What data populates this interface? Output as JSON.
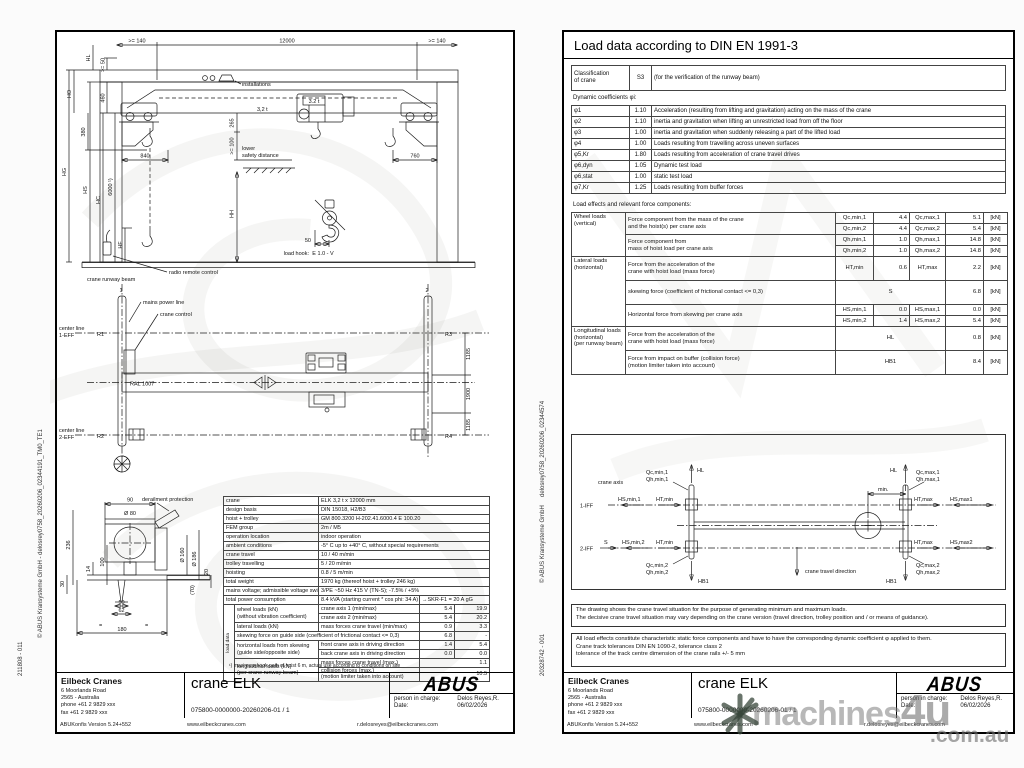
{
  "lp": {
    "side_copyright": "© ABUS Kransysteme GmbH - delosrey0758_20260206_02344191_TM0_TE1",
    "side_number": "211808 - 011",
    "draw": {
      "dim_140a": ">= 140",
      "dim_12000": "12000",
      "dim_140b": ">= 140",
      "hl": "HL",
      "dim_50": ">= 50",
      "ho": "HO",
      "dim_460": "460",
      "dim_380": "380",
      "hg": "HG",
      "hs": "HS",
      "hc": "HC",
      "dim_6000": "6000 ¹)",
      "hf": "HF",
      "hh": "HH",
      "installations": "installations",
      "beam_capacity": "3,2 t",
      "hoist_capacity": "3.2 t",
      "dim_265": "265",
      "dim_100": ">= 100",
      "lower": "lower",
      "safety_distance": "safety distance",
      "dim_840": "840",
      "dim_760": "760",
      "load_hook": "load hook:",
      "hook_type": "E 1.0 - V",
      "dim_hook_50": "50",
      "radio": "radio remote control",
      "runway_beam": "crane runway beam",
      "rail_1": "1",
      "rail_2": "2",
      "mains": "mains power line",
      "crane_control": "crane control",
      "center_line_1a": "center line",
      "center_line_1b": "1-EFF",
      "center_line_2a": "center line",
      "center_line_2b": "2-EFF",
      "r1": "R1",
      "r2": "R2",
      "r3": "R3",
      "r4": "R4",
      "ral": "RAL 1007",
      "dim_1185a": "1185",
      "dim_1900": "1900",
      "dim_1185b": "1185",
      "derailment": "derailment protection",
      "dim_90": "90",
      "dim_d80": "Ø 80",
      "dim_236": "236",
      "dim_100b": "100",
      "dim_14": "14",
      "dim_30": "30",
      "dim_d160": "Ø 160",
      "dim_d186": "Ø 186",
      "dim_20": "20",
      "dim_50b": "50",
      "dim_62": "62",
      "dim_180": "180",
      "dim_70": "(70)",
      "eq1": "=",
      "eq2": "="
    },
    "spec": {
      "rows": [
        {
          "l": "crane",
          "v": "ELK  3,2 t x 12000 mm"
        },
        {
          "l": "design basis",
          "v": "DIN 15018, H2/B3"
        },
        {
          "l": "hoist + trolley",
          "v": "GM 800.3200 H-202.41.6000.4 E 100.20"
        },
        {
          "l": "FEM group",
          "v": "2m / M5"
        },
        {
          "l": "operation location",
          "v": "indoor operation"
        },
        {
          "l": "ambient conditions",
          "v": "-5° C up to +40° C, without special requirements"
        },
        {
          "l": "crane travel",
          "v": "10 / 40 m/min"
        },
        {
          "l": "trolley travelling",
          "v": "5 / 20 m/min"
        },
        {
          "l": "hoisting",
          "v": "0.8 / 5 m/min"
        },
        {
          "l": "total weight",
          "v": "1970 kg (thereof hoist + trolley 246 kg)"
        },
        {
          "l": "mains voltage; admissible voltage swing",
          "v": "3/PE ~50 Hz 415 V (TN-S); -7.5% / +5%"
        }
      ],
      "power": {
        "l": "total power consumption",
        "v": "8.4 kVA (starting current * cos phi: 34 A)",
        "extra": "→SKR-F1 = 20 A gG"
      }
    },
    "ld": {
      "side": "load data",
      "wheel_l1": "wheel loads (kN)",
      "wheel_l2": "(without vibration coefficient)",
      "axis1": "crane axis 1 (min/max)",
      "axis1_min": "5.4",
      "axis1_max": "19.9",
      "axis2": "crane axis 2 (min/max)",
      "axis2_min": "5.4",
      "axis2_max": "20.2",
      "lateral_l": "lateral loads (kN)",
      "mass": "mass forces crane travel (min/max)",
      "mass_min": "0.9",
      "mass_max": "3.3",
      "skew": "skewing force on guide side (coefficient of frictional contact <= 0,3)",
      "skew_v1": "6.8",
      "skew_v2": "-",
      "horiz_l1": "horizontal loads from skewing",
      "horiz_l2": "(guide side/opposite side)",
      "front": "front crane axis in driving direction",
      "front_min": "1.4",
      "front_max": "5.4",
      "back": "back crane axis in driving direction",
      "back_min": "0.0",
      "back_max": "0.0",
      "long_l1": "longitudinal loads (kN)",
      "long_l2": "(per crane runway beam)",
      "mass2": "mass forces crane travel (max.)",
      "mass2_v": "1.1",
      "coll1": "collision forces (max.)",
      "coll2": "(motion limiter taken into account)",
      "coll_v": "10.5",
      "footnote": "¹) maximum hook path of hoist 6 m, actual use according to conditions on site"
    }
  },
  "rp": {
    "title": "Load data according to DIN EN 1991-3",
    "classification": {
      "l1": "Classification",
      "l2": "of crane",
      "value": "S3",
      "note": "(for the verification of the runway beam)"
    },
    "coeff_header": "Dynamic coefficients φi:",
    "coeffs": [
      {
        "s": "φ1",
        "v": "1.10",
        "d": "Acceleration (resulting from lifting and gravitation) acting on the mass of the crane"
      },
      {
        "s": "φ2",
        "v": "1.10",
        "d": "inertia and gravitation when lifting an unrestricted load from off the floor"
      },
      {
        "s": "φ3",
        "v": "1.00",
        "d": "inertia and gravitation when suddenly releasing a part of the lifted load"
      },
      {
        "s": "φ4",
        "v": "1.00",
        "d": "Loads resulting from travelling across uneven surfaces"
      },
      {
        "s": "φ5,Kr",
        "v": "1.80",
        "d": "Loads resulting from acceleration of crane travel drives"
      },
      {
        "s": "φ6,dyn",
        "v": "1.05",
        "d": "Dynamic test load"
      },
      {
        "s": "φ6,stat",
        "v": "1.00",
        "d": "static test load"
      },
      {
        "s": "φ7,Kr",
        "v": "1.25",
        "d": "Loads resulting from buffer forces"
      }
    ],
    "loads_header": "Load effects and relevant force components:",
    "loads": {
      "g1a": "Wheel loads",
      "g1b": "(vertical)",
      "r1a": "Force component from the mass of the crane",
      "r1b": "and the hoist(s) per crane axis",
      "s1": "Qc,min,1",
      "v1": "4.4",
      "s2": "Qc,max,1",
      "v2": "5.1",
      "s3": "Qc,min,2",
      "v3": "4.4",
      "s4": "Qc,max,2",
      "v4": "5.4",
      "r2a": "Force component from",
      "r2b": "mass of hoist load per crane axis",
      "s5": "Qh,min,1",
      "v5": "1.0",
      "s6": "Qh,max,1",
      "v6": "14.8",
      "s7": "Qh,min,2",
      "v7": "1.0",
      "s8": "Qh,max,2",
      "v8": "14.8",
      "g2a": "Lateral loads",
      "g2b": "(horizontal)",
      "r3a": "Force from the acceleration of the",
      "r3b": "crane with hoist load (mass force)",
      "s9": "HT,min",
      "v9": "0.6",
      "s10": "HT,max",
      "v10": "2.2",
      "r4": "skewing force (coefficient of frictional contact <= 0,3)",
      "s11": "S",
      "v11": "6.8",
      "r5": "Horizontal force from skewing per crane axis",
      "s12": "HS,min,1",
      "v12": "0.0",
      "s13": "HS,max,1",
      "v13": "0.0",
      "s14": "HS,min,2",
      "v14": "1.4",
      "s15": "HS,max,2",
      "v15": "5.4",
      "g3a": "Longitudinal loads",
      "g3b": "(horizontal)",
      "g3c": "(per runway beam)",
      "r6a": "Force from the acceleration of the",
      "r6b": "crane with hoist load (mass force)",
      "s16": "HL",
      "v16": "0.8",
      "r7a": "Force from impact on buffer (collision force)",
      "r7b": "(motion limiter taken into account)",
      "s17": "HB1",
      "v17": "8.4",
      "unit": "[kN]"
    },
    "diag": {
      "axis": "crane axis",
      "iff1": "1-IFF",
      "iff2": "2-IFF",
      "hl": "HL",
      "min": "min.",
      "qcmin1": "Qc,min,1",
      "qhmin1": "Qh,min,1",
      "qcmax1": "Qc,max,1",
      "qhmax1": "Qh,max,1",
      "qcmin2": "Qc,min,2",
      "qhmin2": "Qh,min,2",
      "qcmax2": "Qc,max,2",
      "qhmax2": "Qh,max,2",
      "hsmin1": "HS,min,1",
      "hsmin2": "HS,min,2",
      "hsmax1": "HS,max1",
      "hsmax2": "HS,max2",
      "htmin": "HT,min",
      "htmax": "HT,max",
      "s": "S",
      "hb1": "HB1",
      "dir": "crane travel direction"
    },
    "notes1": [
      "The drawing shows the crane travel situation for the purpose of generating minimum and maximum loads.",
      "The decisive crane travel situation may vary depending on the crane version (travel direction, trolley position and / or means of guidance)."
    ],
    "notes2": [
      "All load effects constitute characteristic static force components and have to have the corresponding dynamic coefficient φ applied to them.",
      "Crane track tolerances DIN EN 1090-2, tolerance class 2",
      "tolerance of the track centre dimension of the crane rails +/- 5 mm"
    ],
    "side_number": "20328742 - 001",
    "side_copyright": "© ABUS Kransysteme GmbH",
    "side_file": "delosrey0758_20260206_02344574"
  },
  "footer": {
    "company": "Eilbeck Cranes",
    "addr1": "6 Moorlands Road",
    "addr2": "2565 - Australia",
    "phone": "phone +61 2 9829 xxx",
    "fax": "fax +61 2 9829 xxx",
    "title": "crane ELK",
    "doc": "075800-0000000-20260206-01 / 1",
    "logo": "ABUS",
    "person_label": "person in charge:",
    "person": "Delos Reyes,R.",
    "date_label": "Date:",
    "date": "06/02/2026",
    "version": "ABUKonfis Version 5.24+552",
    "website": "www.eilbeckcranes.com",
    "email": "r.delosreyes@eilbeckcranes.com"
  },
  "wm": {
    "brand": "machines",
    "brand2": "4u",
    "suffix": ".com.au"
  }
}
